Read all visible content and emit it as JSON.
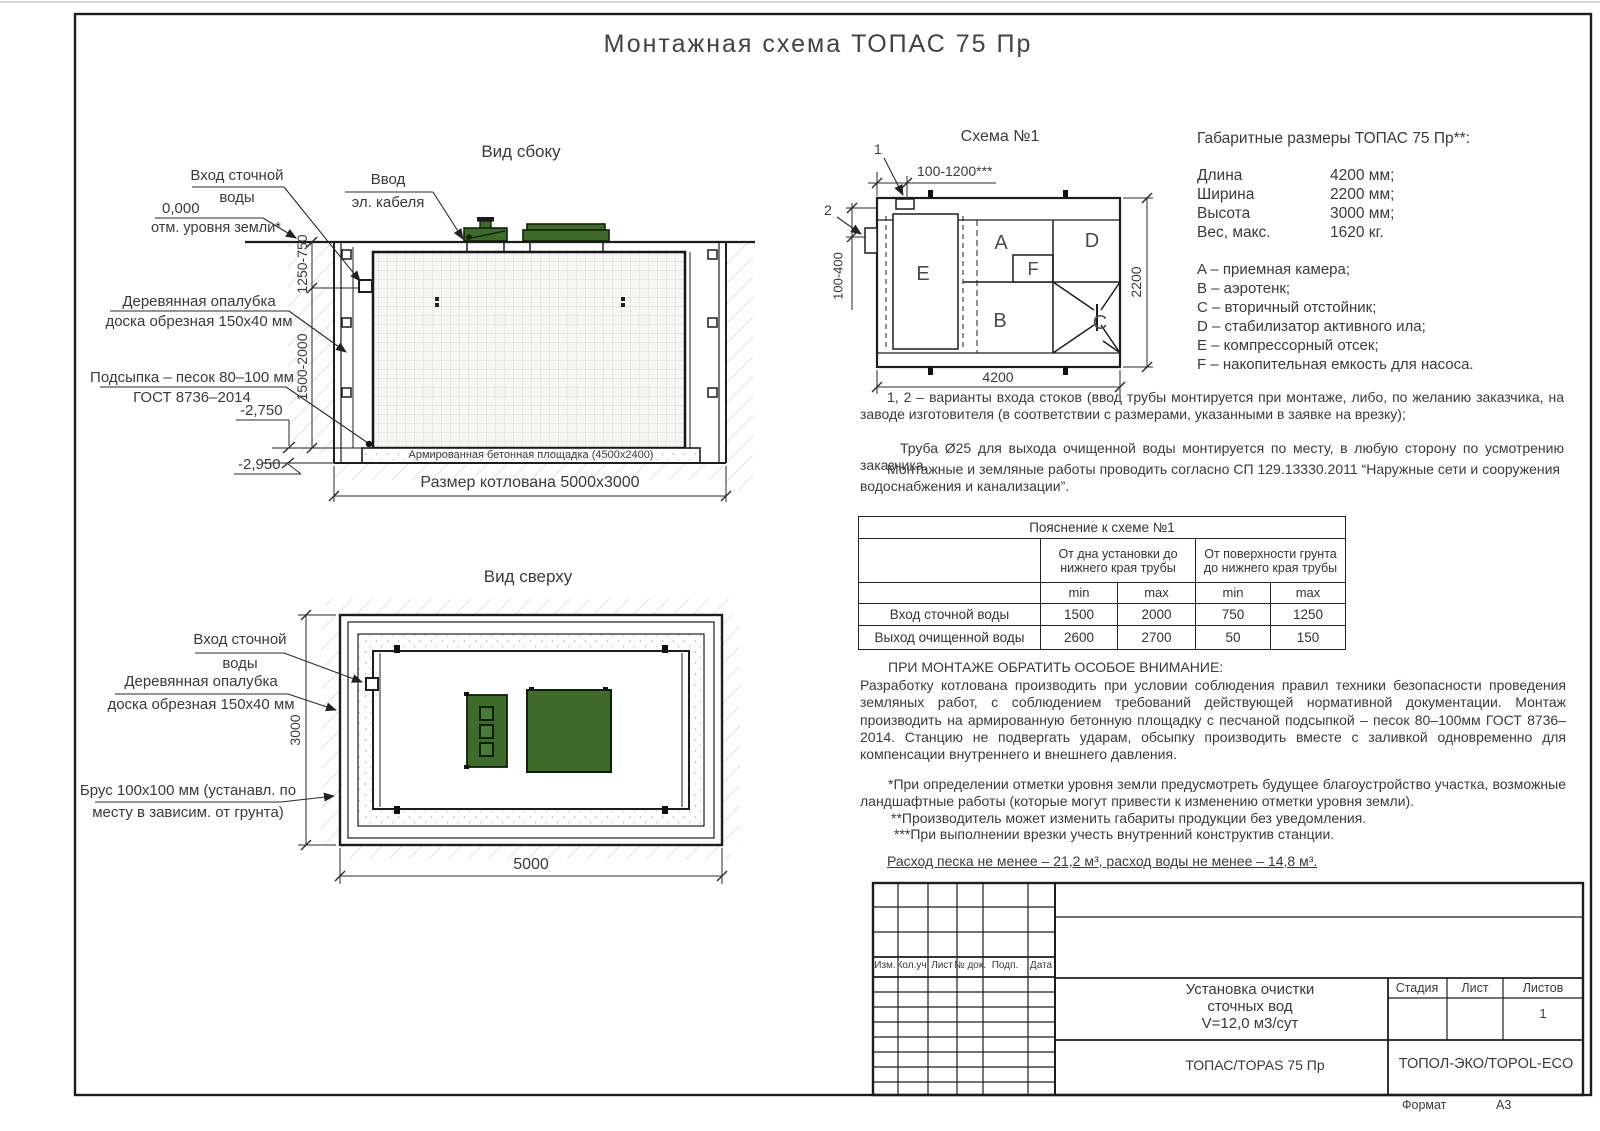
{
  "page": {
    "title": "Монтажная схема ТОПАС 75 Пр",
    "format_label": "Формат",
    "format_value": "А3"
  },
  "side_view": {
    "title": "Вид сбоку",
    "inlet_label_1": "Вход сточной",
    "inlet_label_2": "воды",
    "ground_level_1": "0,000",
    "ground_level_2": "отм. уровня земли*",
    "cable_label_1": "Ввод",
    "cable_label_2": "эл. кабеля",
    "formwork_label_1": "Деревянная опалубка",
    "formwork_label_2": "доска обрезная 150х40 мм",
    "sand_label_1": "Подсыпка – песок 80–100 мм",
    "sand_label_2": "ГОСТ 8736–2014",
    "dim_inlet_depth": "1250-750",
    "dim_pit_depth": "1500-2000",
    "elevation_pad": "-2,750",
    "elevation_bottom": "-2,950",
    "pad_label": "Армированная бетонная площадка (4500х2400)",
    "pit_size": "Размер котлована 5000х3000"
  },
  "top_view": {
    "title": "Вид сверху",
    "inlet_label_1": "Вход сточной",
    "inlet_label_2": "воды",
    "formwork_label_1": "Деревянная опалубка",
    "formwork_label_2": "доска обрезная 150х40 мм",
    "beam_label_1": "Брус 100х100 мм (устанавл. по",
    "beam_label_2": "месту в зависим. от грунта)",
    "dim_width": "3000",
    "dim_length": "5000"
  },
  "schema": {
    "title": "Схема №1",
    "callout_1": "1",
    "callout_2": "2",
    "dim_inlet_offset": "100-1200***",
    "dim_side_inlet": "100-400",
    "dim_width": "2200",
    "dim_length": "4200",
    "chamber_a": "A",
    "chamber_b": "B",
    "chamber_c": "C",
    "chamber_d": "D",
    "chamber_e": "E",
    "chamber_f": "F"
  },
  "specs": {
    "title": "Габаритные размеры ТОПАС 75 Пр**:",
    "rows": [
      {
        "name": "Длина",
        "value": "4200 мм;"
      },
      {
        "name": "Ширина",
        "value": "2200 мм;"
      },
      {
        "name": "Высота",
        "value": "3000 мм;"
      },
      {
        "name": "Вес, макс.",
        "value": "1620 кг."
      }
    ],
    "legend": [
      "A – приемная камера;",
      "B – аэротенк;",
      "C – вторичный отстойник;",
      "D – стабилизатор активного ила;",
      "E – компрессорный отсек;",
      "F – накопительная емкость для насоса."
    ]
  },
  "notes": {
    "variants": "1, 2 – варианты входа  стоков (ввод трубы монтируется при монтаже, либо, по желанию заказчика, на заводе изготовителя (в соответствии с размерами, указанными в заявке на врезку);",
    "outlet_pipe": "Труба Ø25 для выхода очищенной воды монтируется по месту, в любую сторону по усмотрению заказчика.",
    "regulations": "Монтажные и земляные работы проводить согласно СП 129.13330.2011 “Наружные сети и сооружения водоснабжения и канализации”."
  },
  "table": {
    "title": "Пояснение к схеме №1",
    "group_1": "От дна установки до нижнего края трубы",
    "group_2": "От поверхности грунта до нижнего края трубы",
    "min_label": "min",
    "max_label": "max",
    "rows": [
      {
        "name": "Вход сточной воды",
        "c1": "1500",
        "c2": "2000",
        "c3": "750",
        "c4": "1250"
      },
      {
        "name": "Выход очищенной воды",
        "c1": "2600",
        "c2": "2700",
        "c3": "50",
        "c4": "150"
      }
    ]
  },
  "attention": {
    "title": "ПРИ МОНТАЖЕ ОБРАТИТЬ ОСОБОЕ ВНИМАНИЕ:",
    "body": "Разработку котлована производить при условии соблюдения правил техники безопасности проведения земляных работ, с соблюдением требований действующей нормативной документации.  Монтаж производить на армированную бетонную площадку с песчаной подсыпкой – песок 80–100мм ГОСТ 8736–2014. Станцию не подвергать ударам, обсыпку производить вместе с заливкой одновременно для компенсации внутреннего и внешнего давления.",
    "footnote_1": "*При определении отметки уровня земли предусмотреть будущее благоустройство участка, возможные ландшафтные работы (которые могут привести к изменению отметки уровня земли).",
    "footnote_2": "**Производитель может изменить габариты продукции без уведомления.",
    "footnote_3": "***При выполнении врезки учесть внутренний конструктив станции.",
    "consumption": "Расход песка не менее – 21,2 м³, расход воды не менее – 14,8 м³."
  },
  "title_block": {
    "columns": [
      "Изм.",
      "Кол.уч.",
      "Лист",
      "№ док.",
      "Подп.",
      "Дата"
    ],
    "doc_title_1": "Установка очистки",
    "doc_title_2": "сточных вод",
    "doc_title_3": "V=12,0 м3/сут",
    "model": "ТОПАС/TOPAS 75 Пр",
    "stage_label": "Стадия",
    "sheet_label": "Лист",
    "sheets_label": "Листов",
    "sheets_value": "1",
    "company": "ТОПОЛ-ЭКО/TOPOL-ECO"
  }
}
